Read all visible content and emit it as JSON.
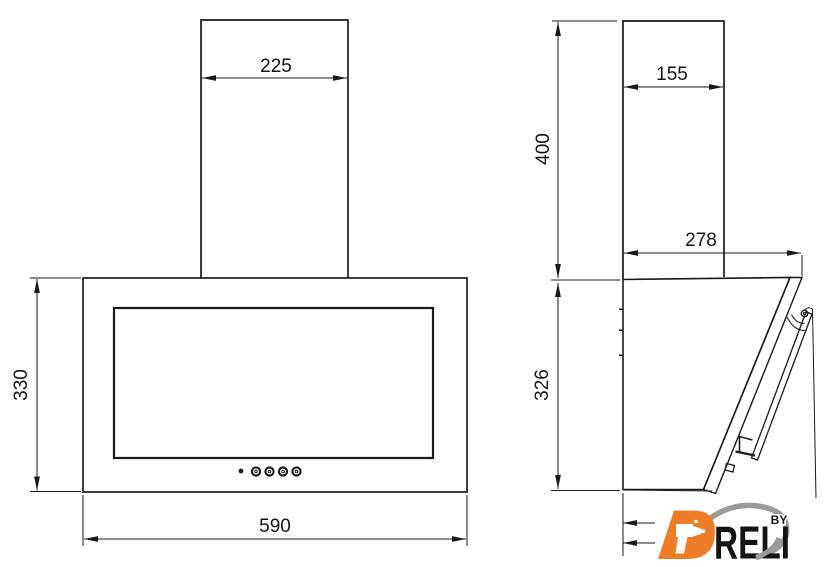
{
  "drawing": {
    "subject": "wall-mounted kitchen hood, two-view dimensioned technical drawing",
    "views": {
      "left": "front view",
      "right": "side view"
    }
  },
  "dimensions": {
    "front_duct_width": "225",
    "front_body_height": "330",
    "front_body_width": "590",
    "side_duct_depth": "155",
    "side_chimney_height": "400",
    "side_total_depth": "278",
    "side_body_height": "326"
  },
  "logo": {
    "brand": "DRELI",
    "suffix": "BY"
  },
  "colors": {
    "line": "#1a1a1a",
    "logo_orange": "#EF7D27",
    "logo_grey": "#9A9A9A",
    "background": "#ffffff"
  }
}
